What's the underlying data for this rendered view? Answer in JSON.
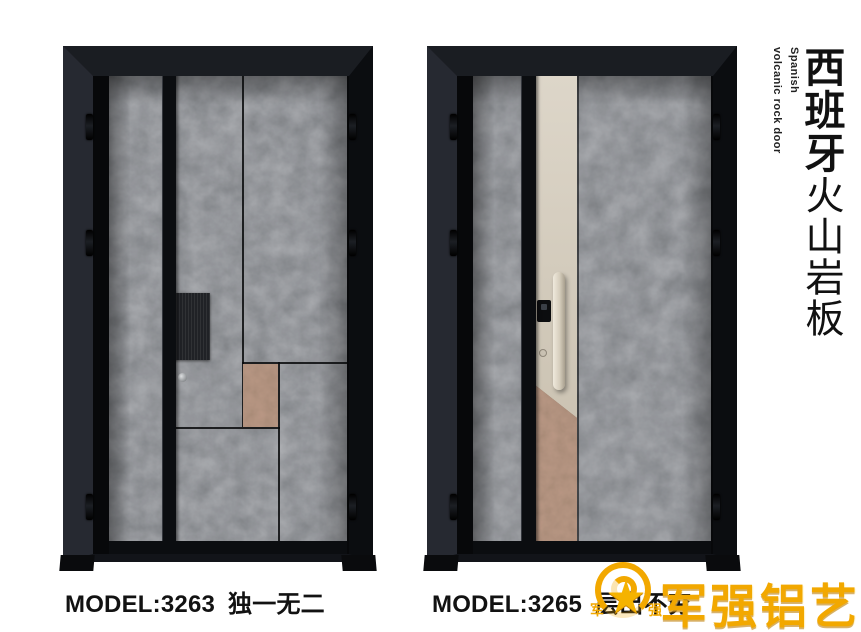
{
  "sidebar": {
    "en_line1": "Spanish",
    "en_line2": "volcanic rock door",
    "cn_bold": "西班牙",
    "cn_regular": "火山岩板"
  },
  "products": [
    {
      "model": "MODEL:3263",
      "name": "独一无二"
    },
    {
      "model": "MODEL:3265",
      "name": "层出不穷"
    }
  ],
  "brand": {
    "logo_text": "军强铝艺",
    "badge_char_left": "军",
    "badge_char_right": "强",
    "badge_star": "★"
  },
  "colors": {
    "gold": "#f2a800",
    "rock_base": "#46494c",
    "rust_accent": "#744c3a",
    "champagne_strip": "#d2cabb",
    "frame_black": "#0e1013",
    "background": "#ffffff"
  }
}
